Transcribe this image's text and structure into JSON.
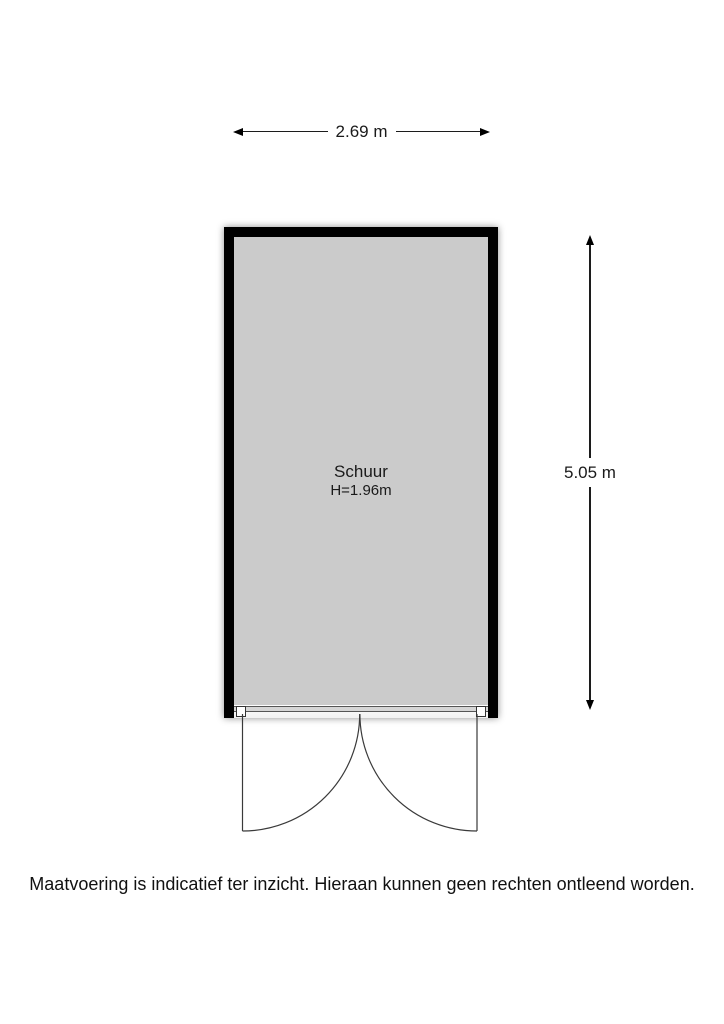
{
  "floorplan": {
    "width_dimension": {
      "label": "2.69 m"
    },
    "height_dimension": {
      "label": "5.05 m"
    },
    "room": {
      "name": "Schuur",
      "ceiling_height": "H=1.96m"
    },
    "disclaimer": "Maatvoering is indicatief ter inzicht. Hieraan kunnen geen rechten ontleend worden.",
    "colors": {
      "wall": "#000000",
      "floor": "#cbcbcb",
      "background": "#ffffff",
      "door_line": "#3a3a3a",
      "dimension_line": "#1c1c1c"
    }
  }
}
